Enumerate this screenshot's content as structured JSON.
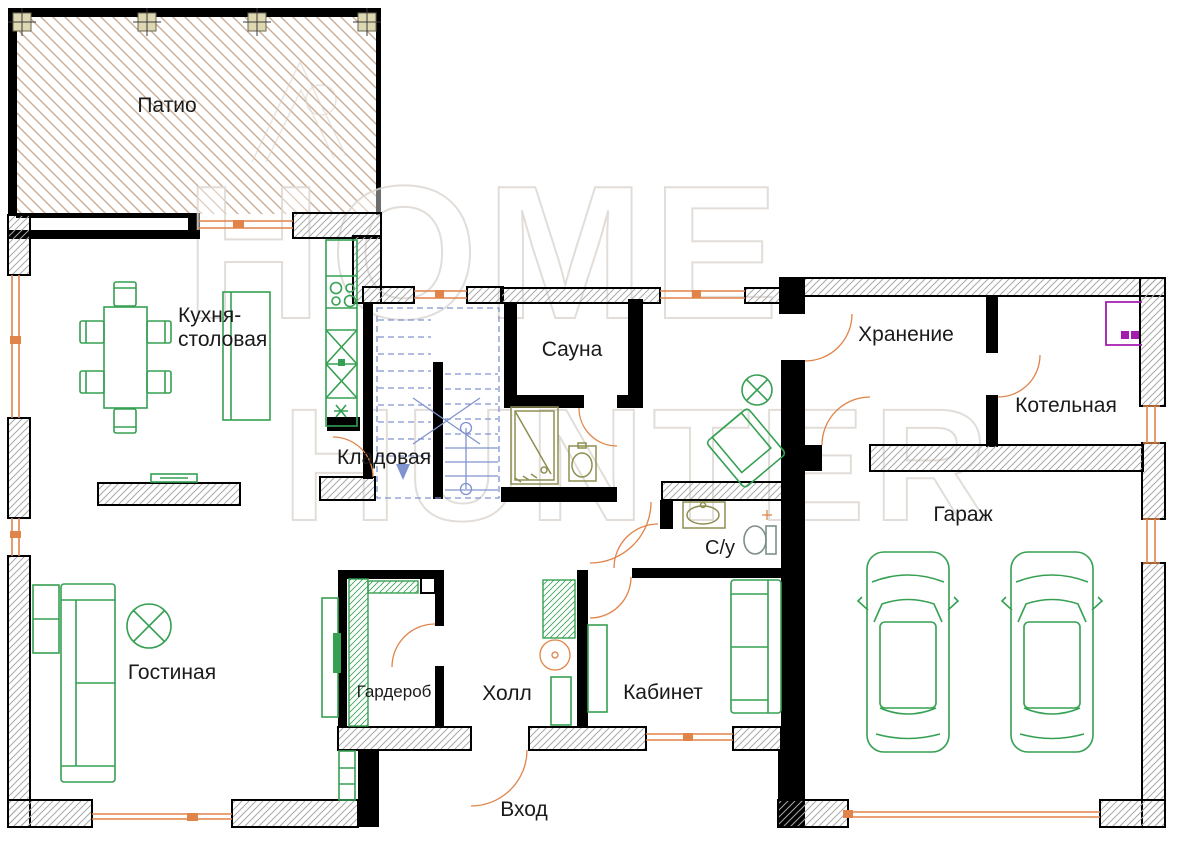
{
  "watermark": {
    "line1": "HOME",
    "line2": "HUNTER"
  },
  "rooms": {
    "patio": {
      "label": "Патио"
    },
    "kitchen": {
      "label_line1": "Кухня-",
      "label_line2": "столовая"
    },
    "pantry": {
      "label": "Кладовая"
    },
    "sauna": {
      "label": "Сауна"
    },
    "storage": {
      "label": "Хранение"
    },
    "boiler_room": {
      "label": "Котельная"
    },
    "garage": {
      "label": "Гараж"
    },
    "bathroom": {
      "label": "С/у"
    },
    "living_room": {
      "label": "Гостиная"
    },
    "wardrobe": {
      "label": "Гардероб"
    },
    "hall": {
      "label": "Холл"
    },
    "study": {
      "label": "Кабинет"
    },
    "entrance": {
      "label": "Вход"
    }
  },
  "colors": {
    "wall": "#000000",
    "wallhatch": "#a8a8a8",
    "patiohatch": "#c9ab93",
    "column": "#ded8b2",
    "furniture": "#35a052",
    "door": "#e08449",
    "stairs": "#8093cf",
    "fixture": "#8f8f52",
    "toilet": "#7d8f85",
    "boiler": "#a21caf",
    "label": "#1a1a1a",
    "watermark": "#ddd8d2"
  }
}
